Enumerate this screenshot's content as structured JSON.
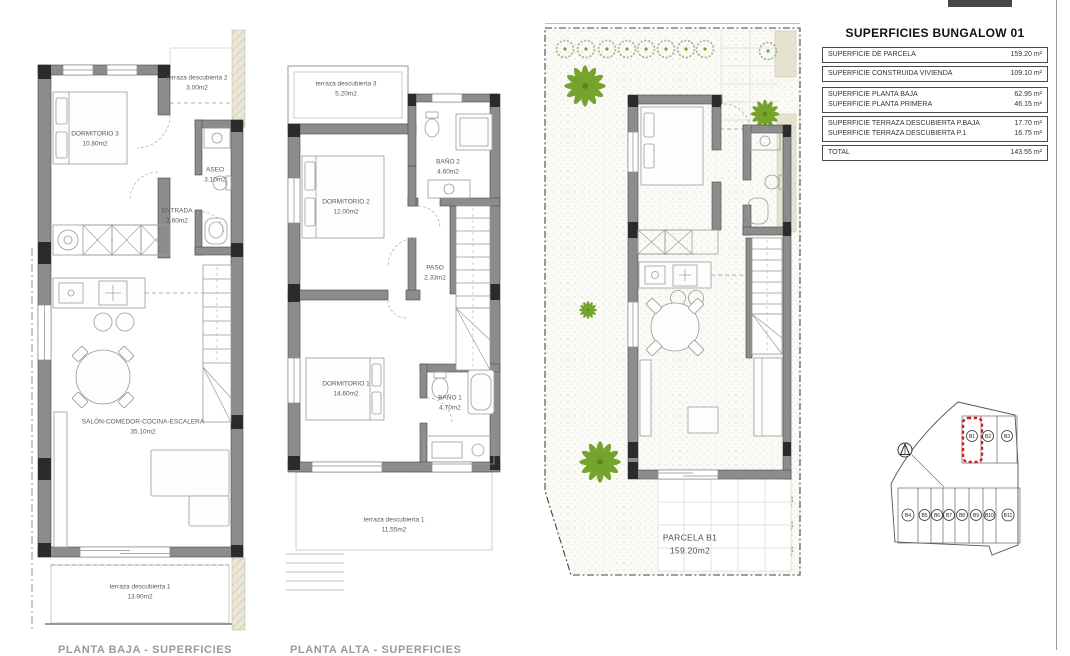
{
  "areas_table": {
    "title": "SUPERFICIES BUNGALOW 01",
    "rows_single": [
      {
        "label": "SUPERFICIE DE PARCELA",
        "value": "159.20 m²"
      },
      {
        "label": "SUPERFICIE CONSTRUIDA VIVIENDA",
        "value": "109.10 m²"
      }
    ],
    "rows_floors": [
      {
        "label": "SUPERFICIE PLANTA BAJA",
        "value": "62.95 m²"
      },
      {
        "label": "SUPERFICIE PLANTA PRIMERA",
        "value": "46.15 m²"
      }
    ],
    "rows_terraces": [
      {
        "label": "SUPERFICIE TERRAZA DESCUBIERTA P.BAJA",
        "value": "17.70 m²"
      },
      {
        "label": "SUPERFICIE TERRAZA DESCUBIERTA P.1",
        "value": "16.75 m²"
      }
    ],
    "total": {
      "label": "TOTAL",
      "value": "143.55 m²"
    }
  },
  "plan_ground": {
    "footer": "PLANTA BAJA - SUPERFICIES",
    "rooms": {
      "dormitorio3": {
        "name": "DORMITORIO 3",
        "area": "10.80m2"
      },
      "terraza2": {
        "name": "terraza descubierta 2",
        "area": "3.00m2"
      },
      "aseo": {
        "name": "ASEO",
        "area": "3.10m2"
      },
      "entrada": {
        "name": "ENTRADA",
        "area": "2.60m2"
      },
      "salon": {
        "name": "SALÓN-COMEDOR-COCINA-ESCALERA",
        "area": "35.10m2"
      },
      "terraza1": {
        "name": "terraza descubierta 1",
        "area": "13.90m2"
      }
    }
  },
  "plan_first": {
    "footer": "PLANTA ALTA - SUPERFICIES",
    "rooms": {
      "terraza3": {
        "name": "terraza descubierta 3",
        "area": "5.20m2"
      },
      "dormitorio2": {
        "name": "DORMITORIO 2",
        "area": "12.00m2"
      },
      "bano2": {
        "name": "BAÑO 2",
        "area": "4.60m2"
      },
      "paso": {
        "name": "PASO",
        "area": "2.33m2"
      },
      "dormitorio1": {
        "name": "DORMITORIO 1",
        "area": "14.60m2"
      },
      "bano1": {
        "name": "BAÑO 1",
        "area": "4.70m2"
      },
      "terraza1": {
        "name": "terraza descubierta 1",
        "area": "11.55m2"
      }
    }
  },
  "plan_site": {
    "parcel": {
      "name": "PARCELA B1",
      "area": "159.20m2"
    }
  },
  "keyplan": {
    "plots": [
      "B1",
      "B2",
      "B3",
      "B4",
      "B5",
      "B6",
      "B7",
      "B8",
      "B9",
      "B10",
      "B11"
    ],
    "highlighted": "B1"
  },
  "colors": {
    "accent_red": "#cf1f1f",
    "garden_green": "#76a32c",
    "wall_gray": "#8c8c8c"
  }
}
